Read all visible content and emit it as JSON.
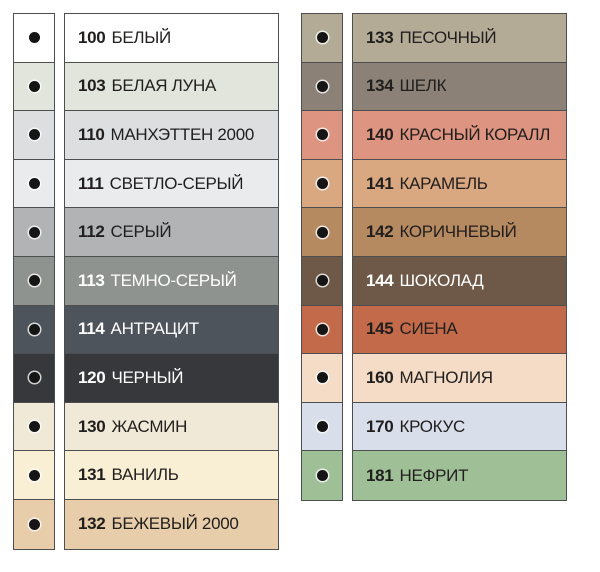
{
  "palette_meta": {
    "border_color": "#4d4e50",
    "dot_color": "#151515",
    "dot_ring_color": "rgba(255,255,255,0.78)",
    "text_dark": "#211e1e",
    "text_light": "#ffffff"
  },
  "columns": [
    {
      "rows": [
        {
          "code": "100",
          "name": "БЕЛЫЙ",
          "color": "#ffffff",
          "text": "dark"
        },
        {
          "code": "103",
          "name": "БЕЛАЯ ЛУНА",
          "color": "#e2e5dc",
          "text": "dark"
        },
        {
          "code": "110",
          "name": "МАНХЭТТЕН 2000",
          "color": "#dcdee0",
          "text": "dark"
        },
        {
          "code": "111",
          "name": "СВЕТЛО-СЕРЫЙ",
          "color": "#e9ebed",
          "text": "dark"
        },
        {
          "code": "112",
          "name": "СЕРЫЙ",
          "color": "#b1b3b5",
          "text": "dark"
        },
        {
          "code": "113",
          "name": "ТЕМНО-СЕРЫЙ",
          "color": "#8f938f",
          "text": "light"
        },
        {
          "code": "114",
          "name": "АНТРАЦИТ",
          "color": "#4d545c",
          "text": "light"
        },
        {
          "code": "120",
          "name": "ЧЕРНЫЙ",
          "color": "#36383b",
          "text": "light"
        },
        {
          "code": "130",
          "name": "ЖАСМИН",
          "color": "#f1e9d7",
          "text": "dark"
        },
        {
          "code": "131",
          "name": "ВАНИЛЬ",
          "color": "#f9efd4",
          "text": "dark"
        },
        {
          "code": "132",
          "name": "БЕЖЕВЫЙ 2000",
          "color": "#e7cda9",
          "text": "dark"
        }
      ]
    },
    {
      "rows": [
        {
          "code": "133",
          "name": "ПЕСОЧНЫЙ",
          "color": "#b4ab97",
          "text": "dark"
        },
        {
          "code": "134",
          "name": "ШЕЛК",
          "color": "#8b8176",
          "text": "dark"
        },
        {
          "code": "140",
          "name": "КРАСНЫЙ КОРАЛЛ",
          "color": "#dd9480",
          "text": "dark"
        },
        {
          "code": "141",
          "name": "КАРАМЕЛЬ",
          "color": "#d9a880",
          "text": "dark"
        },
        {
          "code": "142",
          "name": "КОРИЧНЕВЫЙ",
          "color": "#b68a61",
          "text": "dark"
        },
        {
          "code": "144",
          "name": "ШОКОЛАД",
          "color": "#6e5847",
          "text": "light"
        },
        {
          "code": "145",
          "name": "СИЕНА",
          "color": "#c36a4b",
          "text": "dark"
        },
        {
          "code": "160",
          "name": "МАГНОЛИЯ",
          "color": "#f4dcc6",
          "text": "dark"
        },
        {
          "code": "170",
          "name": "КРОКУС",
          "color": "#d8dfeb",
          "text": "dark"
        },
        {
          "code": "181",
          "name": "НЕФРИТ",
          "color": "#9fc097",
          "text": "dark"
        }
      ]
    }
  ]
}
